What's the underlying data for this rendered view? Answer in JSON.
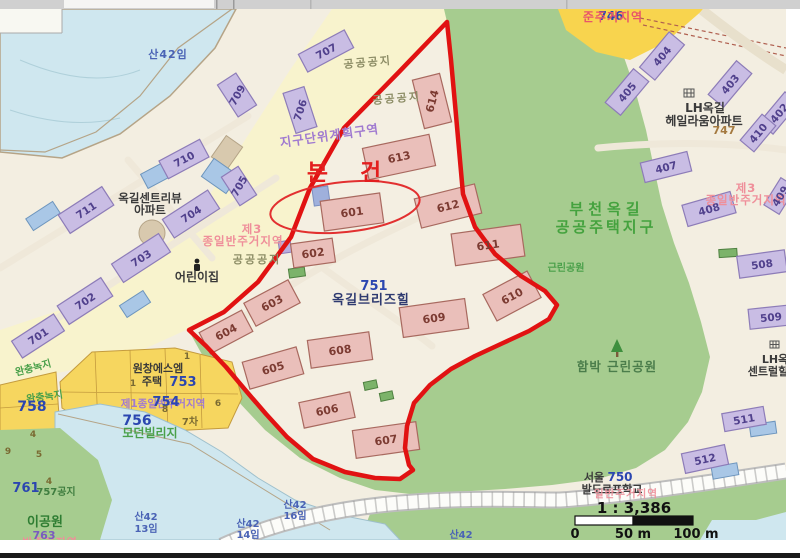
{
  "subject": {
    "marker": "본 건"
  },
  "scale_bar": {
    "ratio": "1 : 3,386",
    "t0": "0",
    "t50": "50 m",
    "t100": "100 m"
  },
  "zones": {
    "san42im": "산42임",
    "district_plan": "지구단위계획구역",
    "public_open_a": "공공공지",
    "public_open_b": "공공공지",
    "public_open_c": "공공공지",
    "semi_resid": "준주거지역",
    "parcel_746": "746",
    "type3_a1": "제3",
    "type3_a2": "종일반주거지역",
    "type3_b1": "제3",
    "type3_b2": "종일반주거지역",
    "type1": "제1종일반주거지역",
    "bucheon_1": "부천옥길",
    "bucheon_2": "공공주택지구",
    "hambak_park": "함박 근린공원",
    "neighborhood_park": "근린공원",
    "buffer_green_a": "완충녹지",
    "buffer_green_b": "완충녹지",
    "resid_fragment": "반주거지역",
    "public_757": "757공지",
    "san42_13_1": "산42",
    "san42_13_2": "13임",
    "san42_14_1": "산42",
    "san42_14_2": "14임",
    "san42_16_1": "산42",
    "san42_16_2": "16임",
    "san42_plain": "산42"
  },
  "places": {
    "centreview_1": "옥길센트리뷰",
    "centreview_2": "아파트",
    "daycare": "어린이집",
    "breezehill_no": "751",
    "breezehill": "옥길브리즈힐",
    "heilaum_1": "LH옥길",
    "heilaum_2": "헤일라움아파트",
    "central_1": "LH옥",
    "central_2": "센트럴힐",
    "wonchang_1": "원창에스엠",
    "wonchang_2": "주택",
    "wonchang_no": "753",
    "modern_village": "모던빌리지",
    "waldorf_1": "서울",
    "waldorf_no": "750",
    "waldorf_2": "발도르프학교",
    "waldorf_overlay": "일반주거지역",
    "child_park": "이공원",
    "p763": "763",
    "p747": "747",
    "p754": "754",
    "p756": "756",
    "p758": "758",
    "p761": "761",
    "p7cha": "7차",
    "d1a": "1",
    "d1b": "1",
    "d4a": "4",
    "d4b": "4",
    "d5": "5",
    "d6": "6",
    "d8": "8",
    "d9": "9"
  },
  "buildings": {
    "601": "601",
    "602": "602",
    "603": "603",
    "604": "604",
    "605": "605",
    "606": "606",
    "607": "607",
    "608": "608",
    "609": "609",
    "610": "610",
    "611": "611",
    "612": "612",
    "613": "613",
    "614": "614",
    "701": "701",
    "702": "702",
    "703": "703",
    "704": "704",
    "705": "705",
    "706": "706",
    "707": "707",
    "709": "709",
    "710": "710",
    "711": "711",
    "402": "402",
    "403": "403",
    "404": "404",
    "405": "405",
    "407": "407",
    "408": "408",
    "409": "409",
    "410": "410",
    "508": "508",
    "509": "509",
    "511": "511",
    "512": "512"
  },
  "colors": {
    "boundary_red": "#e11212",
    "subject_text_red": "#e31e1e",
    "park_green": "#a6cc8f",
    "forest_blue": "#cfe7ef",
    "road_yellow": "#f8f3cd",
    "parcel_yellow": "#f6d65f",
    "building_pink": "#eabfba",
    "building_purple": "#c9bde4"
  }
}
